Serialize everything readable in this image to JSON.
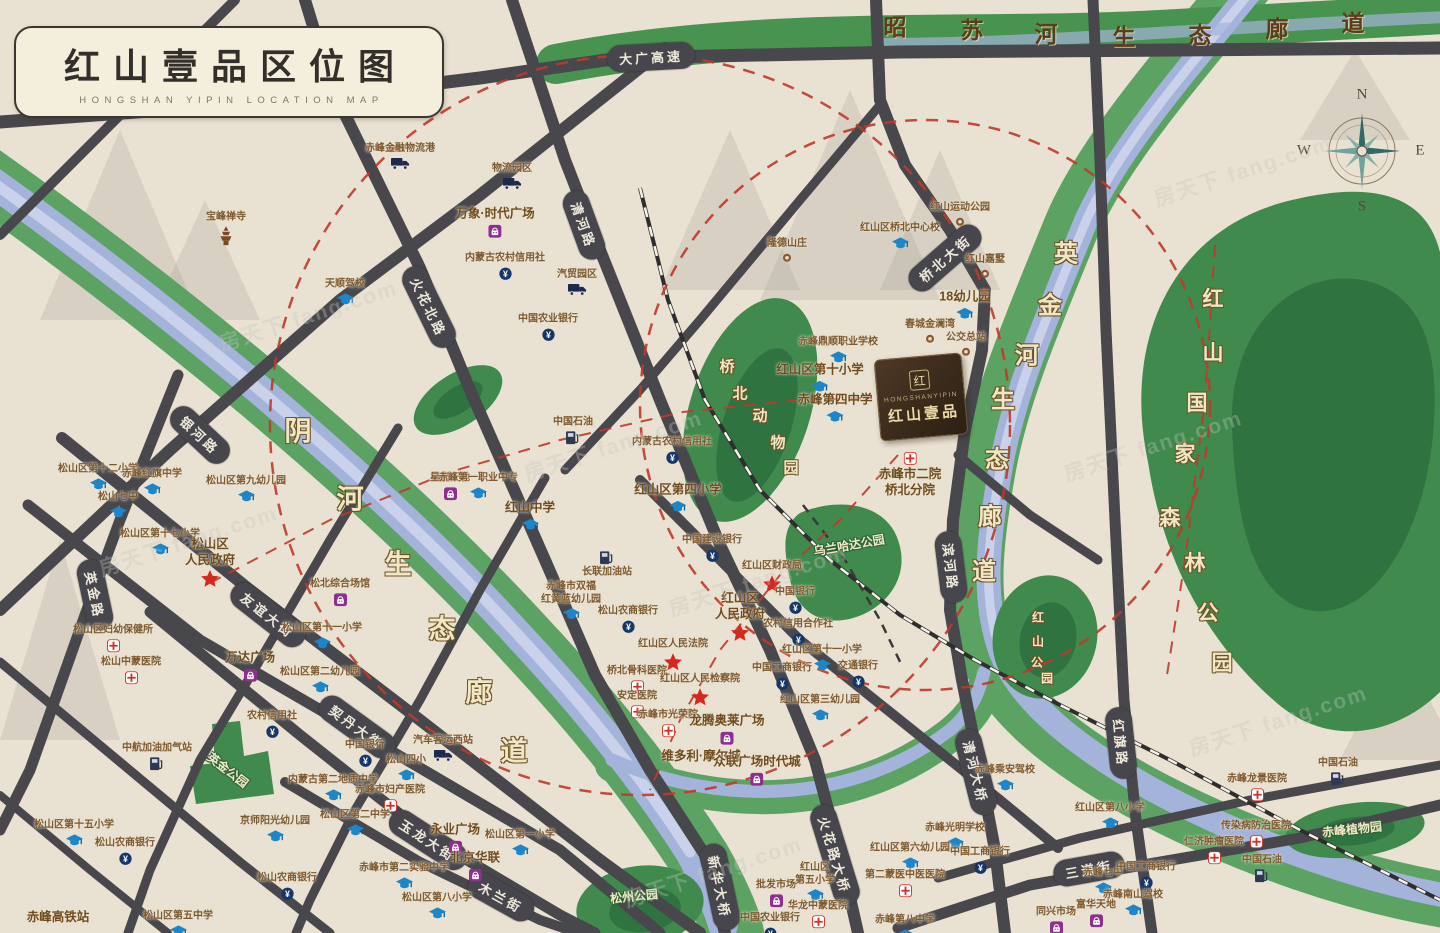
{
  "title": {
    "cn": "红山壹品区位图",
    "en": "HONGSHAN YIPIN LOCATION MAP"
  },
  "compass": {
    "n": "N",
    "e": "E",
    "s": "S",
    "w": "W"
  },
  "project": {
    "logo_char": "红",
    "name_en": "HONGSHANYIPIN",
    "name_cn": "红山壹品"
  },
  "colors": {
    "background": "#e9e1d1",
    "road": "#47474c",
    "water_blue": "#a4b3d9",
    "corridor_green": "#5ba263",
    "park_green": "#3f8a4c",
    "park_green_dark": "#2e7340",
    "red_dash": "#bf3a2b",
    "gov_star_red": "#d5281e",
    "school_blue": "#1d86c8",
    "shopping_purple": "#8d2f8f",
    "bank_navy": "#15356b",
    "hospital_red": "#d03028"
  },
  "road_labels": [
    {
      "t": "大广高速",
      "x": 651,
      "y": 57,
      "r": -3
    },
    {
      "t": "清河路",
      "x": 584,
      "y": 225,
      "r": 70
    },
    {
      "t": "火花北路",
      "x": 429,
      "y": 307,
      "r": 64
    },
    {
      "t": "银河路",
      "x": 200,
      "y": 435,
      "r": 43
    },
    {
      "t": "英金路",
      "x": 95,
      "y": 595,
      "r": 78
    },
    {
      "t": "友谊大街",
      "x": 268,
      "y": 615,
      "r": 38
    },
    {
      "t": "契丹大街",
      "x": 357,
      "y": 727,
      "r": 36
    },
    {
      "t": "玉龙大街",
      "x": 428,
      "y": 840,
      "r": 33
    },
    {
      "t": "木兰街",
      "x": 501,
      "y": 897,
      "r": 29
    },
    {
      "t": "新华大桥",
      "x": 720,
      "y": 887,
      "r": 78
    },
    {
      "t": "火花路大桥",
      "x": 835,
      "y": 855,
      "r": 73
    },
    {
      "t": "清河大桥",
      "x": 976,
      "y": 772,
      "r": 76
    },
    {
      "t": "桥北大街",
      "x": 945,
      "y": 258,
      "r": -41
    },
    {
      "t": "滨河路",
      "x": 951,
      "y": 567,
      "r": 83
    },
    {
      "t": "红旗路",
      "x": 1121,
      "y": 743,
      "r": 84
    },
    {
      "t": "三道街",
      "x": 1089,
      "y": 869,
      "r": -10
    }
  ],
  "corridors": [
    {
      "name": "yin-river-corridor",
      "cls": "cream",
      "s": 27,
      "chars": [
        [
          "阴",
          298,
          429
        ],
        [
          "河",
          350,
          497
        ],
        [
          "生",
          398,
          562
        ],
        [
          "态",
          442,
          627
        ],
        [
          "廊",
          479,
          690
        ],
        [
          "道",
          514,
          749
        ]
      ]
    },
    {
      "name": "yingjin-river-corridor",
      "cls": "cream",
      "s": 24,
      "chars": [
        [
          "英",
          1066,
          251
        ],
        [
          "金",
          1050,
          303
        ],
        [
          "河",
          1027,
          353
        ],
        [
          "生",
          1003,
          397
        ],
        [
          "态",
          997,
          457
        ],
        [
          "廊",
          990,
          514
        ],
        [
          "道",
          984,
          569
        ]
      ]
    },
    {
      "name": "zhaosu-river-corridor",
      "cls": "brown",
      "s": 23,
      "chars": [
        [
          "昭",
          895,
          25
        ],
        [
          "苏",
          972,
          28
        ],
        [
          "河",
          1046,
          32
        ],
        [
          "生",
          1124,
          35
        ],
        [
          "态",
          1200,
          33
        ],
        [
          "廊",
          1277,
          27
        ],
        [
          "道",
          1353,
          21
        ]
      ]
    },
    {
      "name": "hongshan-forest-park",
      "cls": "cream",
      "s": 21,
      "chars": [
        [
          "红",
          1213,
          298
        ],
        [
          "山",
          1213,
          352
        ],
        [
          "国",
          1197,
          402
        ],
        [
          "家",
          1185,
          453
        ],
        [
          "森",
          1170,
          517
        ],
        [
          "林",
          1195,
          562
        ],
        [
          "公",
          1208,
          612
        ],
        [
          "园",
          1222,
          662
        ]
      ]
    },
    {
      "name": "qiaobei-zoo",
      "cls": "cream",
      "s": 15,
      "chars": [
        [
          "桥",
          727,
          366
        ],
        [
          "北",
          740,
          393
        ],
        [
          "动",
          760,
          415
        ],
        [
          "物",
          778,
          442
        ],
        [
          "园",
          791,
          467
        ]
      ]
    },
    {
      "name": "hongshan-park",
      "cls": "cream",
      "s": 12,
      "chars": [
        [
          "红",
          1038,
          617
        ],
        [
          "山",
          1038,
          641
        ],
        [
          "公",
          1037,
          662
        ],
        [
          "园",
          1047,
          678
        ]
      ]
    }
  ],
  "park_labels": [
    {
      "t": "英金公园",
      "x": 228,
      "y": 770,
      "r": 38,
      "s": 12
    },
    {
      "t": "乌兰哈达公园",
      "x": 849,
      "y": 545,
      "r": -10,
      "s": 12
    },
    {
      "t": "松州公园",
      "x": 634,
      "y": 896,
      "r": -6,
      "s": 12
    },
    {
      "t": "赤峰植物园",
      "x": 1352,
      "y": 829,
      "r": -6,
      "s": 12
    }
  ],
  "pois": [
    {
      "t": "赤峰金融物流港",
      "type": "truck",
      "x": 400,
      "y": 156
    },
    {
      "t": "物流园区",
      "type": "truck",
      "x": 512,
      "y": 176
    },
    {
      "t": "万象·时代广场",
      "type": "bag",
      "x": 495,
      "y": 222,
      "b": 1
    },
    {
      "t": "内蒙古农村信用社",
      "type": "bank",
      "x": 505,
      "y": 266
    },
    {
      "t": "汽贸园区",
      "type": "truck",
      "x": 577,
      "y": 282
    },
    {
      "t": "天顺驾校",
      "type": "cap",
      "x": 345,
      "y": 292
    },
    {
      "t": "宝峰禅寺",
      "type": "temple",
      "x": 226,
      "y": 228
    },
    {
      "t": "中国农业银行",
      "type": "bank",
      "x": 548,
      "y": 327
    },
    {
      "t": "星光天地",
      "type": "bag",
      "x": 450,
      "y": 486
    },
    {
      "t": "松山区第十二小学",
      "type": "cap",
      "x": 98,
      "y": 477
    },
    {
      "t": "赤峰红旗中学",
      "type": "cap",
      "x": 152,
      "y": 482
    },
    {
      "t": "松山七中",
      "type": "cap",
      "x": 118,
      "y": 505
    },
    {
      "t": "松山区第九幼儿园",
      "type": "cap",
      "x": 246,
      "y": 489
    },
    {
      "t": "松山区第十七小学",
      "type": "cap",
      "x": 160,
      "y": 542
    },
    {
      "t": "松山区\n人民政府",
      "type": "gov",
      "x": 210,
      "y": 562,
      "b": 1
    },
    {
      "t": "松北综合场馆",
      "type": "bag",
      "x": 340,
      "y": 592
    },
    {
      "t": "松山区第十一小学",
      "type": "cap",
      "x": 322,
      "y": 636
    },
    {
      "t": "万达广场",
      "type": "bag",
      "x": 250,
      "y": 666,
      "b": 1
    },
    {
      "t": "松山区妇幼保健所",
      "type": "cross",
      "x": 113,
      "y": 638
    },
    {
      "t": "松山中蒙医院",
      "type": "cross",
      "x": 131,
      "y": 670
    },
    {
      "t": "松山区第二幼儿园",
      "type": "cap",
      "x": 320,
      "y": 680
    },
    {
      "t": "中国石油",
      "type": "gas",
      "x": 573,
      "y": 430
    },
    {
      "t": "内蒙古农村信用社",
      "type": "bank",
      "x": 672,
      "y": 450
    },
    {
      "t": "赤峰第一职业中专",
      "type": "cap",
      "x": 478,
      "y": 486
    },
    {
      "t": "红山中学",
      "type": "cap",
      "x": 530,
      "y": 516,
      "b": 1
    },
    {
      "t": "红山区第四小学",
      "type": "cap",
      "x": 678,
      "y": 498,
      "b": 1
    },
    {
      "t": "中国建设银行",
      "type": "bank",
      "x": 712,
      "y": 548
    },
    {
      "t": "长联加油站",
      "type": "gas",
      "x": 607,
      "y": 565,
      "ip": "top"
    },
    {
      "t": "赤峰市双福\n红黄蓝幼儿园",
      "type": "cap",
      "x": 571,
      "y": 601
    },
    {
      "t": "松山农商银行",
      "type": "bank",
      "x": 628,
      "y": 619
    },
    {
      "t": "红山区财政局",
      "type": "gov",
      "x": 772,
      "y": 576
    },
    {
      "t": "中国银行",
      "type": "bank",
      "x": 795,
      "y": 600
    },
    {
      "t": "红山区\n人民政府",
      "type": "gov",
      "x": 740,
      "y": 616,
      "b": 1
    },
    {
      "t": "农村信用合作社",
      "type": "bank",
      "x": 798,
      "y": 632
    },
    {
      "t": "红山区人民法院",
      "type": "gov",
      "x": 673,
      "y": 654
    },
    {
      "t": "红山区第十一小学",
      "type": "cap",
      "x": 822,
      "y": 658
    },
    {
      "t": "交通银行",
      "type": "bank",
      "x": 858,
      "y": 674
    },
    {
      "t": "桥北骨科医院",
      "type": "cross",
      "x": 637,
      "y": 679
    },
    {
      "t": "中国工商银行",
      "type": "bank",
      "x": 782,
      "y": 676
    },
    {
      "t": "红山区人民检察院",
      "type": "gov",
      "x": 700,
      "y": 689
    },
    {
      "t": "安定医院",
      "type": "cross",
      "x": 637,
      "y": 704
    },
    {
      "t": "红山区第三幼儿园",
      "type": "cap",
      "x": 820,
      "y": 708
    },
    {
      "t": "赤峰市光荣院",
      "type": "cross",
      "x": 668,
      "y": 723
    },
    {
      "t": "龙腾奥莱广场",
      "type": "bag",
      "x": 727,
      "y": 729,
      "b": 1
    },
    {
      "t": "维多利·摩尔城",
      "type": "none",
      "x": 701,
      "y": 757,
      "b": 1
    },
    {
      "t": "众联广场时代城",
      "type": "bag",
      "x": 757,
      "y": 770,
      "b": 1
    },
    {
      "t": "中航加油加气站",
      "type": "gas",
      "x": 157,
      "y": 756
    },
    {
      "t": "农村信用社",
      "type": "bank",
      "x": 272,
      "y": 724
    },
    {
      "t": "汽车客运西站",
      "type": "truck",
      "x": 443,
      "y": 748
    },
    {
      "t": "中国银行",
      "type": "bank",
      "x": 365,
      "y": 753
    },
    {
      "t": "松山四小",
      "type": "cap",
      "x": 406,
      "y": 768
    },
    {
      "t": "内蒙古第二地质中学",
      "type": "cap",
      "x": 333,
      "y": 788
    },
    {
      "t": "赤峰市妇产医院",
      "type": "cross",
      "x": 390,
      "y": 798
    },
    {
      "t": "京师阳光幼儿园",
      "type": "cap",
      "x": 275,
      "y": 829
    },
    {
      "t": "松山区第二中学",
      "type": "cap",
      "x": 355,
      "y": 823
    },
    {
      "t": "松山区第十五小学",
      "type": "cap",
      "x": 74,
      "y": 833
    },
    {
      "t": "松山农商银行",
      "type": "bank",
      "x": 125,
      "y": 851
    },
    {
      "t": "松山农商银行",
      "type": "bank",
      "x": 287,
      "y": 886
    },
    {
      "t": "赤峰高铁站",
      "type": "none",
      "x": 58,
      "y": 918,
      "b": 1
    },
    {
      "t": "松山区第五中学",
      "type": "cap",
      "x": 178,
      "y": 924
    },
    {
      "t": "永业广场",
      "type": "bag",
      "x": 455,
      "y": 838,
      "b": 1
    },
    {
      "t": "北京华联",
      "type": "bag",
      "x": 475,
      "y": 866,
      "b": 1
    },
    {
      "t": "松山区第一小学",
      "type": "cap",
      "x": 520,
      "y": 843
    },
    {
      "t": "赤峰市第二实验中学",
      "type": "cap",
      "x": 404,
      "y": 876
    },
    {
      "t": "松山区第八小学",
      "type": "cap",
      "x": 437,
      "y": 906
    },
    {
      "t": "批发市场",
      "type": "bag",
      "x": 776,
      "y": 893
    },
    {
      "t": "红山区\n第五小学",
      "type": "cap",
      "x": 815,
      "y": 882
    },
    {
      "t": "华龙中蒙医院",
      "type": "cross",
      "x": 818,
      "y": 914
    },
    {
      "t": "中国农业银行",
      "type": "bank",
      "x": 770,
      "y": 926
    },
    {
      "t": "赤峰光明学校",
      "type": "cap",
      "x": 955,
      "y": 836
    },
    {
      "t": "红山区第六幼儿园",
      "type": "cap",
      "x": 910,
      "y": 856
    },
    {
      "t": "中国工商银行",
      "type": "bank",
      "x": 980,
      "y": 860
    },
    {
      "t": "第二蒙医中医医院",
      "type": "cross",
      "x": 905,
      "y": 883
    },
    {
      "t": "赤峰第八中学",
      "type": "cap",
      "x": 905,
      "y": 928
    },
    {
      "t": "赤峰七中",
      "type": "cap",
      "x": 1103,
      "y": 881
    },
    {
      "t": "中国工商银行",
      "type": "bank",
      "x": 1146,
      "y": 875
    },
    {
      "t": "赤峰南山驾校",
      "type": "cap",
      "x": 1133,
      "y": 903
    },
    {
      "t": "富华天地",
      "type": "bag",
      "x": 1096,
      "y": 913
    },
    {
      "t": "同兴市场",
      "type": "bag",
      "x": 1056,
      "y": 920
    },
    {
      "t": "红山区第八小学",
      "type": "cap",
      "x": 1110,
      "y": 816
    },
    {
      "t": "赤峰龙景医院",
      "type": "cross",
      "x": 1257,
      "y": 787
    },
    {
      "t": "传染病防治医院",
      "type": "cross",
      "x": 1256,
      "y": 834
    },
    {
      "t": "仁济肿瘤医院",
      "type": "cross",
      "x": 1214,
      "y": 850
    },
    {
      "t": "中国石油",
      "type": "gas",
      "x": 1338,
      "y": 771
    },
    {
      "t": "中国石油",
      "type": "gas",
      "x": 1262,
      "y": 868
    },
    {
      "t": "赤峰乘安驾校",
      "type": "cap",
      "x": 1005,
      "y": 778
    },
    {
      "t": "红山运动公园",
      "type": "dot",
      "x": 960,
      "y": 214
    },
    {
      "t": "红山区桥北中心校",
      "type": "cap",
      "x": 900,
      "y": 236
    },
    {
      "t": "隆德山庄",
      "type": "dot",
      "x": 787,
      "y": 250
    },
    {
      "t": "红山嘉墅",
      "type": "dot",
      "x": 985,
      "y": 266
    },
    {
      "t": "18幼儿园",
      "type": "cap",
      "x": 965,
      "y": 305,
      "b": 1
    },
    {
      "t": "春城金澜湾",
      "type": "dot",
      "x": 930,
      "y": 331
    },
    {
      "t": "公交总站",
      "type": "dot",
      "x": 966,
      "y": 344
    },
    {
      "t": "赤峰鼎顺职业学校",
      "type": "cap",
      "x": 838,
      "y": 350
    },
    {
      "t": "红山区第十小学",
      "type": "cap",
      "x": 820,
      "y": 378,
      "b": 1
    },
    {
      "t": "赤峰第四中学",
      "type": "cap",
      "x": 835,
      "y": 408,
      "b": 1
    },
    {
      "t": "赤峰市二院\n桥北分院",
      "type": "cross",
      "x": 910,
      "y": 475,
      "b": 1,
      "ip": "top"
    }
  ],
  "watermark": {
    "text": "房天下 fang.com",
    "spots": [
      [
        215,
        300
      ],
      [
        520,
        430
      ],
      [
        1150,
        155
      ],
      [
        665,
        565
      ],
      [
        1185,
        705
      ],
      [
        620,
        856
      ],
      [
        95,
        525
      ],
      [
        1060,
        430
      ]
    ]
  }
}
